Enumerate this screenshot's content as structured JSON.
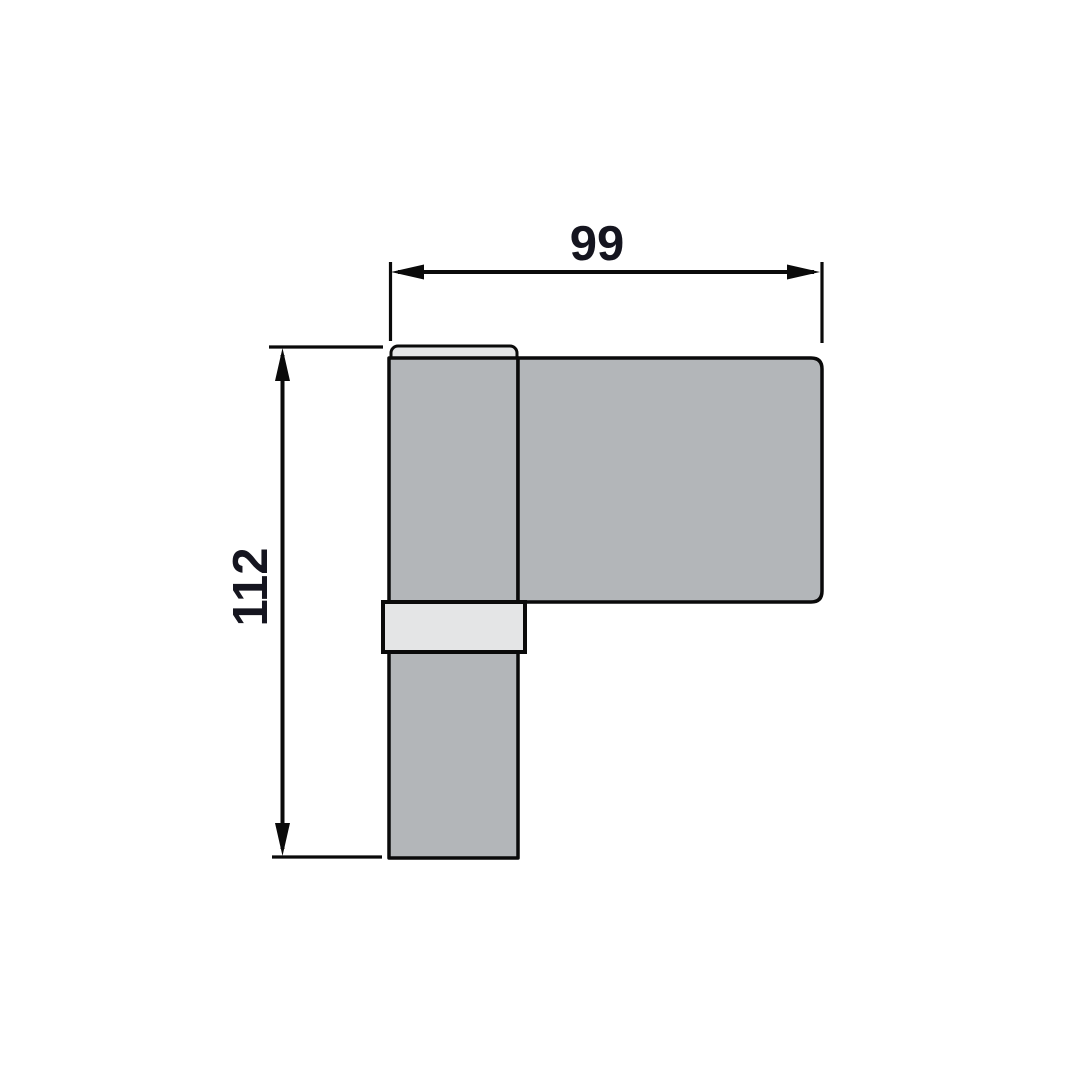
{
  "colors": {
    "background": "#ffffff",
    "part_fill": "#b3b6b9",
    "insert_fill": "#e4e5e6",
    "line": "#0a0a0a",
    "dim_text": "#15151f"
  },
  "dimensions": {
    "width": {
      "label": "99"
    },
    "height": {
      "label": "112"
    }
  }
}
